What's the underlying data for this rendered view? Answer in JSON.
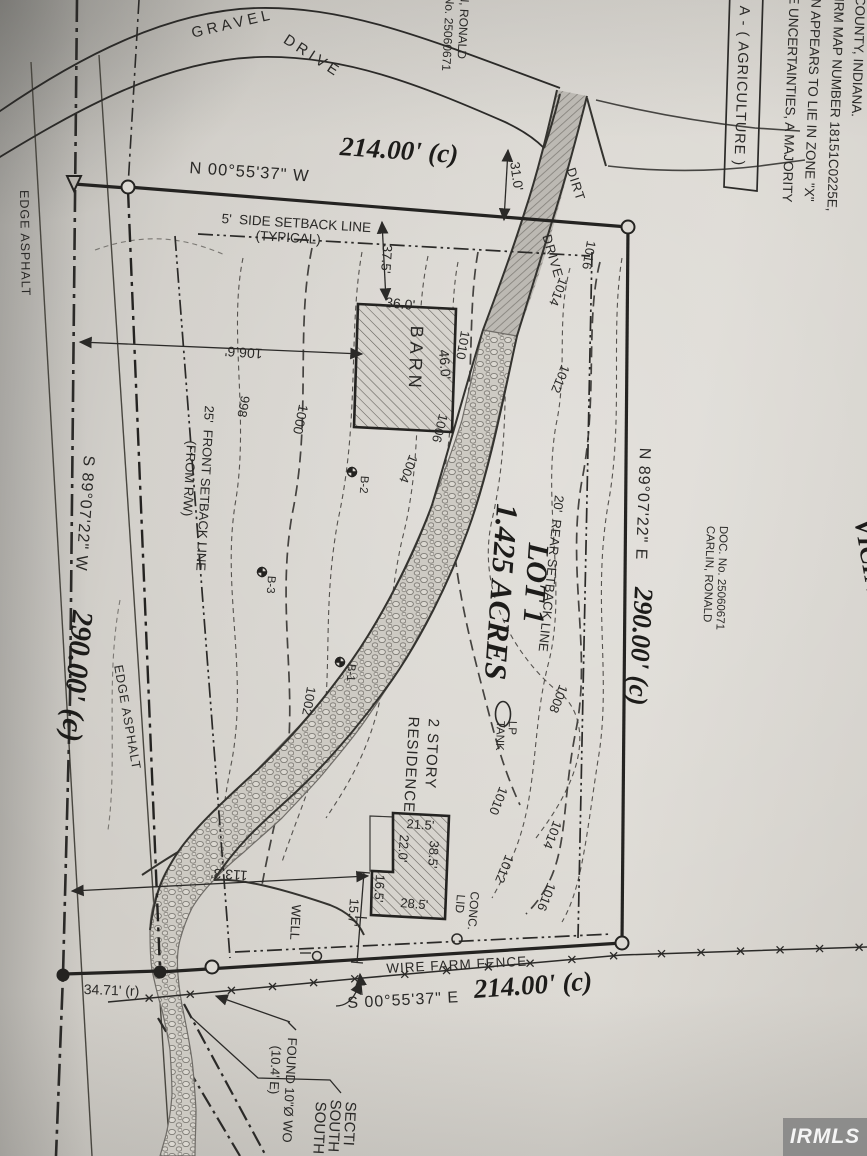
{
  "colors": {
    "paper": "#d8d5cf",
    "ink": "#2b2a28",
    "contour": "#55524e",
    "watermark_bg": "#828282",
    "watermark_text": "#f5f5f5"
  },
  "watermark": {
    "text": "IRMLS"
  },
  "labels": {
    "road_name_1": "GRAVEL",
    "road_name_2": "DRIVE",
    "dirt_1": "DIRT",
    "dirt_2": "DRIVE",
    "north_bearing": "N 00°55'37\" W",
    "north_distance": "214.00' (c)",
    "side_setback_1": "5'  SIDE SETBACK LINE",
    "side_setback_2": "(TYPICAL)",
    "dim_37_5": "37.5'",
    "dim_31_0": "31.0'",
    "barn_dim_36": "36.0'",
    "barn_label": "BARN",
    "barn_dim_46": "46.0'",
    "dim_106_6": "106.6'",
    "front_setback_1": "25'  FRONT SETBACK LINE",
    "front_setback_2": "(FROM R/W)",
    "west_bearing": "S 89°07'22\" W",
    "west_distance": "290.00' (c)",
    "edge_asphalt_1": "EDGE ASPHALT",
    "edge_asphalt_2": "EDGE ASPHALT",
    "c998": "998",
    "c1000": "1000",
    "c1002": "1002",
    "c1004": "1004",
    "c1006": "1006",
    "c1008": "1008",
    "c1010a": "1010",
    "c1010b": "1010",
    "c1012a": "1012",
    "c1012b": "1012",
    "c1014a": "1014",
    "c1014b": "1014",
    "c1016a": "1016",
    "c1016b": "1016",
    "b1": "B-1",
    "b2": "B-2",
    "b3": "B-3",
    "lot_name": "LOT 1",
    "lot_area": "1.425 ACRES",
    "rear_setback": "20'  REAR SETBACK LINE",
    "lp_1": "LP",
    "lp_2": "TANK",
    "res_1": "2 STORY",
    "res_2": "RESIDENCE",
    "rd_21_5": "21.5'",
    "rd_22_0": "22.0'",
    "rd_38_5": "38.5'",
    "rd_16_5": "16.5'",
    "rd_28_5": "28.5'",
    "rd_15_7": "15.7'",
    "conc_1": "CONC.",
    "conc_2": "LID",
    "well": "WELL",
    "dim_113_3": "113.3'",
    "dim_34_71": "34.71' (r)",
    "fence": "WIRE FARM FENCE",
    "south_bearing": "S 00°55'37\" E",
    "south_distance": "214.00' (c)",
    "found_1": "FOUND 10\"Ø WO",
    "found_2": "(10.4' E)",
    "section_1": "SOUTH",
    "section_2": "SOUTH",
    "section_3": "SECTI",
    "carlin_1": "CARLIN, RONALD",
    "carlin_2": "DOC. No. 25060671",
    "east_bearing": "N 89°07'22\" E",
    "east_distance": "290.00' (c)",
    "adjoiner_1": "N, RONALD",
    "adjoiner_2": "No. 25060671",
    "zoning": "A - ( AGRICULTURE )",
    "flood_1": "LE UNCERTAINTIES, A MAJORITY",
    "flood_2": "ON APPEARS TO LIE IN ZONE \"X\"",
    "flood_3": "FIRM MAP NUMBER 18151C0225E,",
    "flood_4": "COUNTY, INDIANA.",
    "vicinity": "VICINITY MAP"
  }
}
